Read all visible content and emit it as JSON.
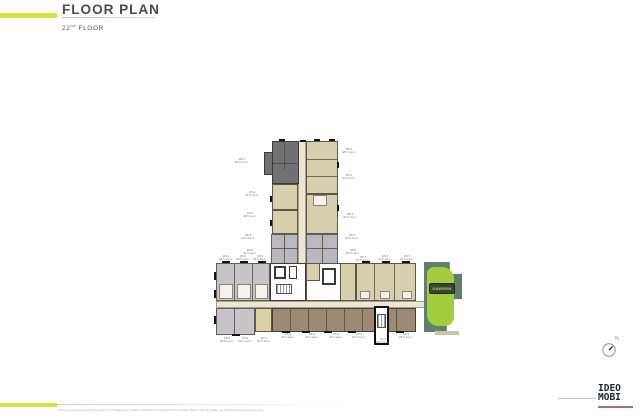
{
  "header": {
    "title": "FLOOR PLAN",
    "floor_number": "22",
    "floor_ordinal": "nd",
    "floor_word": " FLOOR"
  },
  "compass": {
    "north_label": "N"
  },
  "plan": {
    "garden_label": "GARDEN",
    "unit_labels": [
      {
        "text": "2B-1\n55.0 sq.m."
      },
      {
        "text": "1B-2\n34.5 sq.m."
      },
      {
        "text": "1B-2\n34.5 sq.m."
      },
      {
        "text": "1B-3\n31.0 sq.m."
      },
      {
        "text": "1B-3\n31.0 sq.m."
      },
      {
        "text": "2B-2\n48.5 sq.m."
      },
      {
        "text": "1B-4\n30.5 sq.m."
      },
      {
        "text": "1B-4\n30.5 sq.m."
      },
      {
        "text": "1B-5\n29.5 sq.m."
      },
      {
        "text": "1B-5\n29.5 sq.m."
      },
      {
        "text": "ST-1\n22.5 sq.m."
      },
      {
        "text": "1B-6\n26.5 sq.m."
      },
      {
        "text": "1B-6\n26.5 sq.m."
      },
      {
        "text": "1B-6\n26.5 sq.m."
      },
      {
        "text": "1B-7\n27.0 sq.m."
      },
      {
        "text": "1B-7\n27.0 sq.m."
      },
      {
        "text": "1B-8\n26.5 sq.m."
      },
      {
        "text": "1B-8\n26.5 sq.m."
      },
      {
        "text": "ST-2\n24.5 sq.m."
      },
      {
        "text": "1B-9\n26.0 sq.m."
      },
      {
        "text": "1B-9\n26.0 sq.m."
      },
      {
        "text": "1B-9\n26.0 sq.m."
      },
      {
        "text": "1B-9\n26.0 sq.m."
      },
      {
        "text": "ST-3\n22.0 sq.m."
      },
      {
        "text": "1B-9\n26.0 sq.m."
      }
    ]
  },
  "footer": {
    "disclaimer": "The company reserves the right to change and modify information without prior notice. Plans not to scale, for illustration purposes only.",
    "logo_top": "IDEO",
    "logo_bottom": "MOBI"
  },
  "colors": {
    "accent": "#d9e041",
    "garden_green": "#a4cd3d",
    "garden_teal": "#607f6e",
    "logo_navy": "#1d2733"
  }
}
